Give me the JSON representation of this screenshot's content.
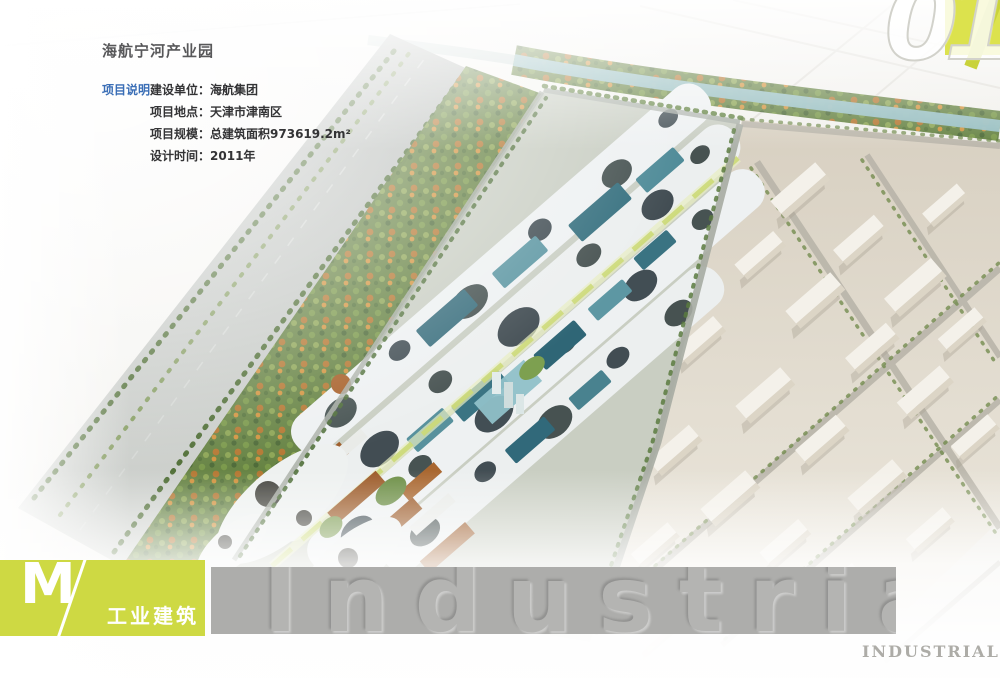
{
  "page_title": "海航宁河产业园",
  "project_info": {
    "label": "项目说明",
    "rows": [
      {
        "key": "建设单位：",
        "value": "海航集团"
      },
      {
        "key": "项目地点：",
        "value": "天津市津南区"
      },
      {
        "key": "项目规模：",
        "value": "总建筑面积973619.2m²"
      },
      {
        "key": "设计时间：",
        "value": "2011年"
      }
    ]
  },
  "chapter": {
    "number": "01"
  },
  "section_tab": {
    "letter": "M",
    "label": "工业建筑"
  },
  "watermark_band": {
    "text": "Industrial"
  },
  "corner_label": "INDUSTRIAL",
  "colors": {
    "accent_yellow_green": "#ced943",
    "chapter_square_yellow": "#dce24d",
    "band_gray": "#adadab",
    "info_label_blue": "#3a6eb6"
  }
}
